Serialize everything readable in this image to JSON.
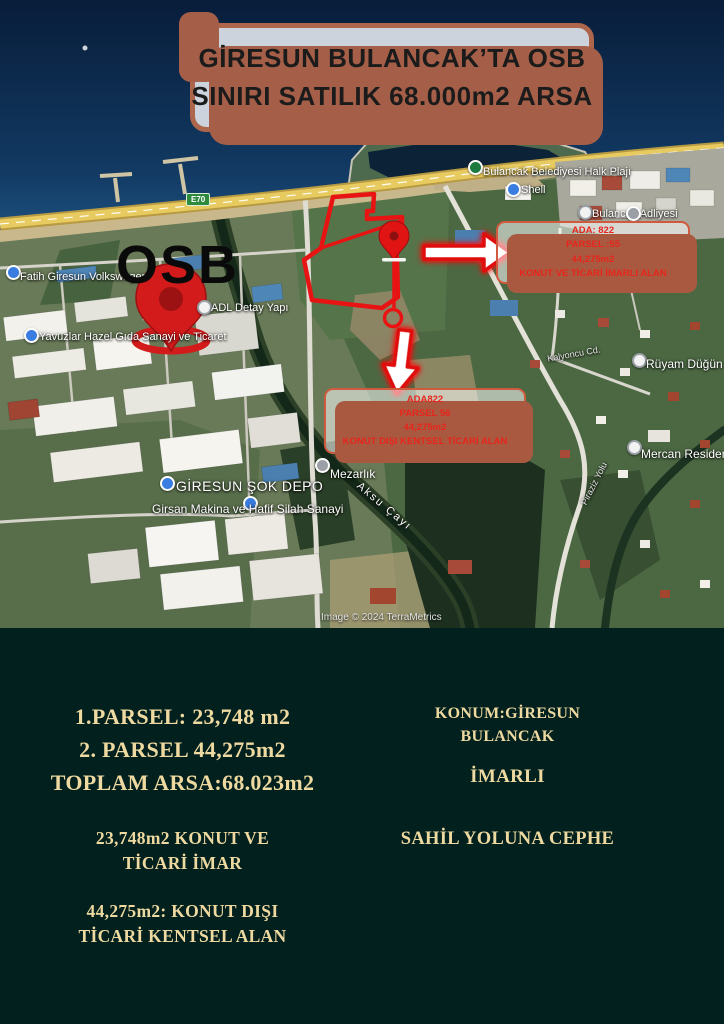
{
  "title": {
    "line1": "GİRESUN BULANCAK’TA OSB",
    "line2": "SINIRI SATILIK 68.000m2 ARSA"
  },
  "map": {
    "osb_label": "OSB",
    "road_badge": "E70",
    "attribution": "Image © 2024 TerraMetrics",
    "info_box_1": {
      "lines": [
        "ADA: 822",
        "PARSEL :55",
        "44,275m2",
        "KONUT VE TİCARİ İMARLI ALAN"
      ]
    },
    "info_box_2": {
      "lines": [
        "ADA822",
        "PARSEL 56",
        "44,275m2",
        "KONUT DIŞI KENTSEL TİCARİ ALAN"
      ]
    },
    "places": {
      "halk_plaji": "Bulancak Belediyesi Halk Plajı",
      "shell": "Shell",
      "adliye": "Bulancak Adliyesi",
      "volkswagen": "Fatih Giresun Volkswagen",
      "detay_yapi": "ADL Detay Yapı",
      "hazel_gida": "Yavuzlar Hazel Gıda Sanayi ve Ticaret",
      "sok_depo": "GİRESUN ŞOK DEPO",
      "girsan": "Girsan Makina ve Hafif Silah Sanayi",
      "mezarlik": "Mezarlık",
      "aksu": "Aksu Çayı",
      "mercan": "Mercan Residence",
      "ruyam": "Rüyam Düğün Sal",
      "kalyoncu": "Kalyoncu Cd.",
      "piraziz": "Piraziz Yolu"
    }
  },
  "details": {
    "parcels": {
      "line1": "1.PARSEL: 23,748 m2",
      "line2": "2. PARSEL 44,275m2",
      "line3": "TOPLAM ARSA:68.023m2"
    },
    "zone1": {
      "line1": "23,748m2 KONUT VE",
      "line2": "TİCARİ İMAR"
    },
    "zone2": {
      "line1": "44,275m2: KONUT DIŞI",
      "line2": "TİCARİ KENTSEL ALAN"
    },
    "location": {
      "line1": "KONUM:GİRESUN",
      "line2": "BULANCAK"
    },
    "status": "İMARLI",
    "frontage": "SAHİL YOLUNA CEPHE"
  },
  "colors": {
    "accent_red": "#e8251d",
    "annotation_red": "#e81313",
    "card_bg": "#ccd3dd",
    "card_border": "#a55f48",
    "bottom_bg": "#02201d",
    "text_cream": "#eed9a0",
    "sea": "#0b2746",
    "highway": "#e8cb60"
  }
}
